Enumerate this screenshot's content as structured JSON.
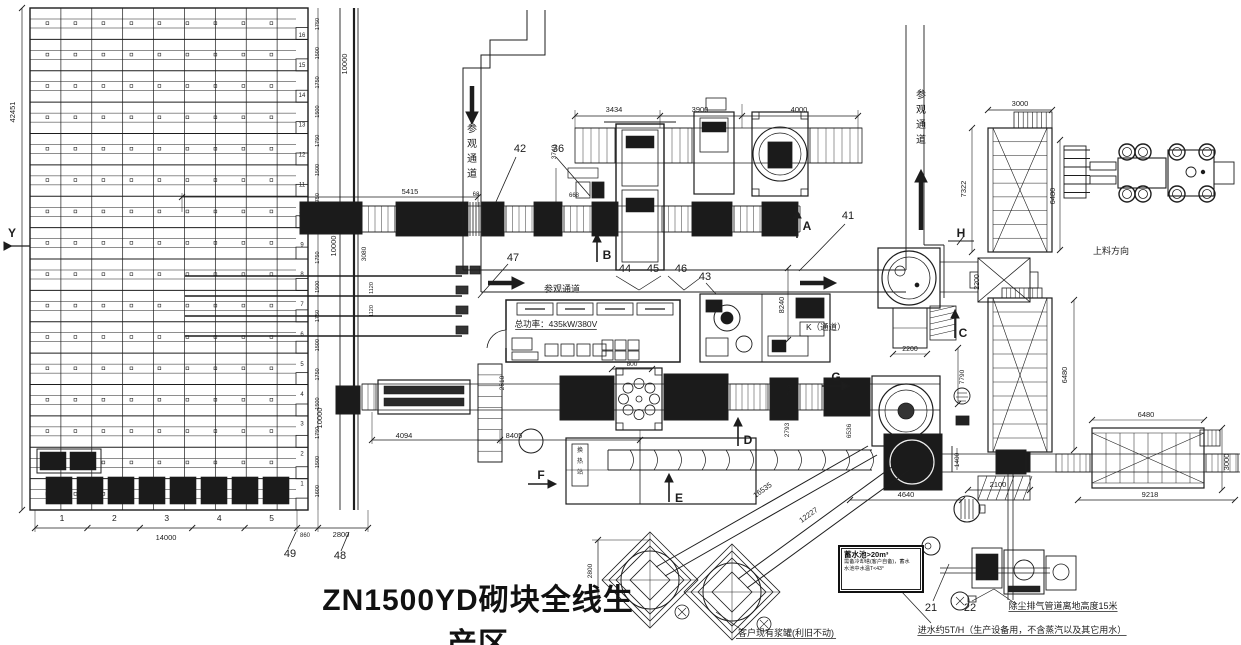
{
  "drawing_title": "ZN1500YD砌块全线生产区",
  "colors": {
    "background": "#ffffff",
    "line": "#1d1d1d",
    "dark_fill": "#1b1b1b"
  },
  "corridors": [
    {
      "text": "参观通道",
      "orientation": "vertical",
      "arrow": "down",
      "x": 472,
      "y": 130
    },
    {
      "text": "参观通道",
      "orientation": "horizontal",
      "arrow": "right",
      "x": 562,
      "y": 289
    },
    {
      "text": "参观通道",
      "orientation": "vertical",
      "arrow": "up",
      "x": 921,
      "y": 96
    }
  ],
  "annotations": [
    {
      "text": "总功率：435kW/380V",
      "x": 556,
      "y": 327,
      "size": 8.5,
      "underline": true
    },
    {
      "text": "K（通道）",
      "x": 806,
      "y": 330,
      "size": 8.5,
      "anchor": "start"
    },
    {
      "text": "上料方向",
      "x": 1111,
      "y": 254,
      "size": 9
    },
    {
      "text": "换热站",
      "x": 576,
      "y": 452,
      "size": 6,
      "vertical": true
    },
    {
      "text": "客户现有浆罐(利旧不动)",
      "x": 786,
      "y": 636,
      "size": 9,
      "underline": true
    },
    {
      "text": "除尘排气管道离地高度15米",
      "x": 1063,
      "y": 609,
      "size": 9,
      "underline": true
    },
    {
      "text": "进水约5T/H（生产设备用，不含蒸汽以及其它用水）",
      "x": 1022,
      "y": 633,
      "size": 9,
      "underline": true
    }
  ],
  "reservoir_note": {
    "lines": [
      "蓄水池>20m³",
      "需备冷却塔(客户自备)，蓄水",
      "水池中水温T<43°"
    ]
  },
  "dimensions": [
    {
      "v": "42451",
      "x": 15,
      "y": 112,
      "r": 1
    },
    {
      "v": "10000",
      "x": 347,
      "y": 64,
      "r": 1
    },
    {
      "v": "10000",
      "x": 336,
      "y": 246,
      "r": 1
    },
    {
      "v": "10000",
      "x": 322,
      "y": 418,
      "r": 1
    },
    {
      "v": "3080",
      "x": 366,
      "y": 254,
      "r": 1,
      "s": 6.5
    },
    {
      "v": "1120",
      "x": 373,
      "y": 288,
      "r": 1,
      "s": 5.5
    },
    {
      "v": "1120",
      "x": 373,
      "y": 311,
      "r": 1,
      "s": 5.5
    },
    {
      "v": "5415",
      "x": 410,
      "y": 194
    },
    {
      "v": "68",
      "x": 476,
      "y": 196,
      "s": 6
    },
    {
      "v": "3740",
      "x": 556,
      "y": 152,
      "r": 1,
      "s": 6.5
    },
    {
      "v": "668",
      "x": 574,
      "y": 197,
      "s": 6
    },
    {
      "v": "3434",
      "x": 614,
      "y": 112
    },
    {
      "v": "3900",
      "x": 700,
      "y": 112
    },
    {
      "v": "4000",
      "x": 799,
      "y": 112
    },
    {
      "v": "8240",
      "x": 784,
      "y": 305,
      "r": 1
    },
    {
      "v": "800",
      "x": 632,
      "y": 366,
      "s": 6.5
    },
    {
      "v": "2610",
      "x": 504,
      "y": 383,
      "r": 1,
      "s": 6.5
    },
    {
      "v": "4094",
      "x": 404,
      "y": 438
    },
    {
      "v": "8405",
      "x": 514,
      "y": 438
    },
    {
      "v": "760",
      "x": 792,
      "y": 390,
      "r": 1,
      "s": 6.5
    },
    {
      "v": "2793",
      "x": 789,
      "y": 430,
      "r": 1,
      "s": 6.5
    },
    {
      "v": "6536",
      "x": 851,
      "y": 431,
      "r": 1,
      "s": 6.5
    },
    {
      "v": "16535",
      "x": 764,
      "y": 492,
      "r": 2
    },
    {
      "v": "12227",
      "x": 810,
      "y": 517,
      "r": 2
    },
    {
      "v": "4640",
      "x": 906,
      "y": 497
    },
    {
      "v": "2100",
      "x": 998,
      "y": 487
    },
    {
      "v": "1400",
      "x": 959,
      "y": 460,
      "r": 1,
      "s": 6.5
    },
    {
      "v": "2200",
      "x": 910,
      "y": 351,
      "s": 7
    },
    {
      "v": "2200",
      "x": 979,
      "y": 282,
      "r": 1,
      "s": 7
    },
    {
      "v": "7790",
      "x": 964,
      "y": 377,
      "r": 1,
      "s": 6.5
    },
    {
      "v": "7322",
      "x": 966,
      "y": 189,
      "r": 1
    },
    {
      "v": "6480",
      "x": 1055,
      "y": 196,
      "r": 1
    },
    {
      "v": "6480",
      "x": 1067,
      "y": 375,
      "r": 1
    },
    {
      "v": "3000",
      "x": 1020,
      "y": 106
    },
    {
      "v": "6480",
      "x": 1146,
      "y": 417
    },
    {
      "v": "3000",
      "x": 1229,
      "y": 462,
      "r": 1
    },
    {
      "v": "9218",
      "x": 1150,
      "y": 497
    },
    {
      "v": "14000",
      "x": 166,
      "y": 540
    },
    {
      "v": "860",
      "x": 305,
      "y": 537,
      "s": 6
    },
    {
      "v": "2800",
      "x": 341,
      "y": 537
    },
    {
      "v": "2800",
      "x": 592,
      "y": 571,
      "r": 1,
      "s": 6.5
    }
  ],
  "item_numbers": [
    {
      "n": "42",
      "x": 520,
      "y": 152
    },
    {
      "n": "36",
      "x": 558,
      "y": 152
    },
    {
      "n": "47",
      "x": 513,
      "y": 261
    },
    {
      "n": "44",
      "x": 625,
      "y": 272
    },
    {
      "n": "45",
      "x": 653,
      "y": 272
    },
    {
      "n": "46",
      "x": 681,
      "y": 272
    },
    {
      "n": "43",
      "x": 705,
      "y": 280
    },
    {
      "n": "41",
      "x": 848,
      "y": 219
    },
    {
      "n": "49",
      "x": 290,
      "y": 557
    },
    {
      "n": "48",
      "x": 340,
      "y": 559
    },
    {
      "n": "21",
      "x": 931,
      "y": 611
    },
    {
      "n": "22",
      "x": 970,
      "y": 611
    }
  ],
  "section_letters": [
    {
      "t": "Y",
      "x": 12,
      "y": 237
    },
    {
      "t": "A",
      "x": 807,
      "y": 230
    },
    {
      "t": "B",
      "x": 607,
      "y": 259
    },
    {
      "t": "C",
      "x": 963,
      "y": 337
    },
    {
      "t": "D",
      "x": 748,
      "y": 444
    },
    {
      "t": "E",
      "x": 679,
      "y": 502
    },
    {
      "t": "F",
      "x": 541,
      "y": 479
    },
    {
      "t": "G",
      "x": 836,
      "y": 381
    },
    {
      "t": "H",
      "x": 961,
      "y": 237
    }
  ],
  "rack": {
    "row_numbers": [
      "16",
      "15",
      "14",
      "13",
      "12",
      "11",
      "10",
      "9",
      "8",
      "7",
      "6",
      "5",
      "4",
      "3",
      "2",
      "1"
    ],
    "column_numbers": [
      "1",
      "2",
      "3",
      "4",
      "5"
    ],
    "side_dims": [
      "1750",
      "1500",
      "1750",
      "1500",
      "1750",
      "1500",
      "1750",
      "1500",
      "1750",
      "1500",
      "1750",
      "1500",
      "1750",
      "1500",
      "1750",
      "1500",
      "1600"
    ]
  }
}
